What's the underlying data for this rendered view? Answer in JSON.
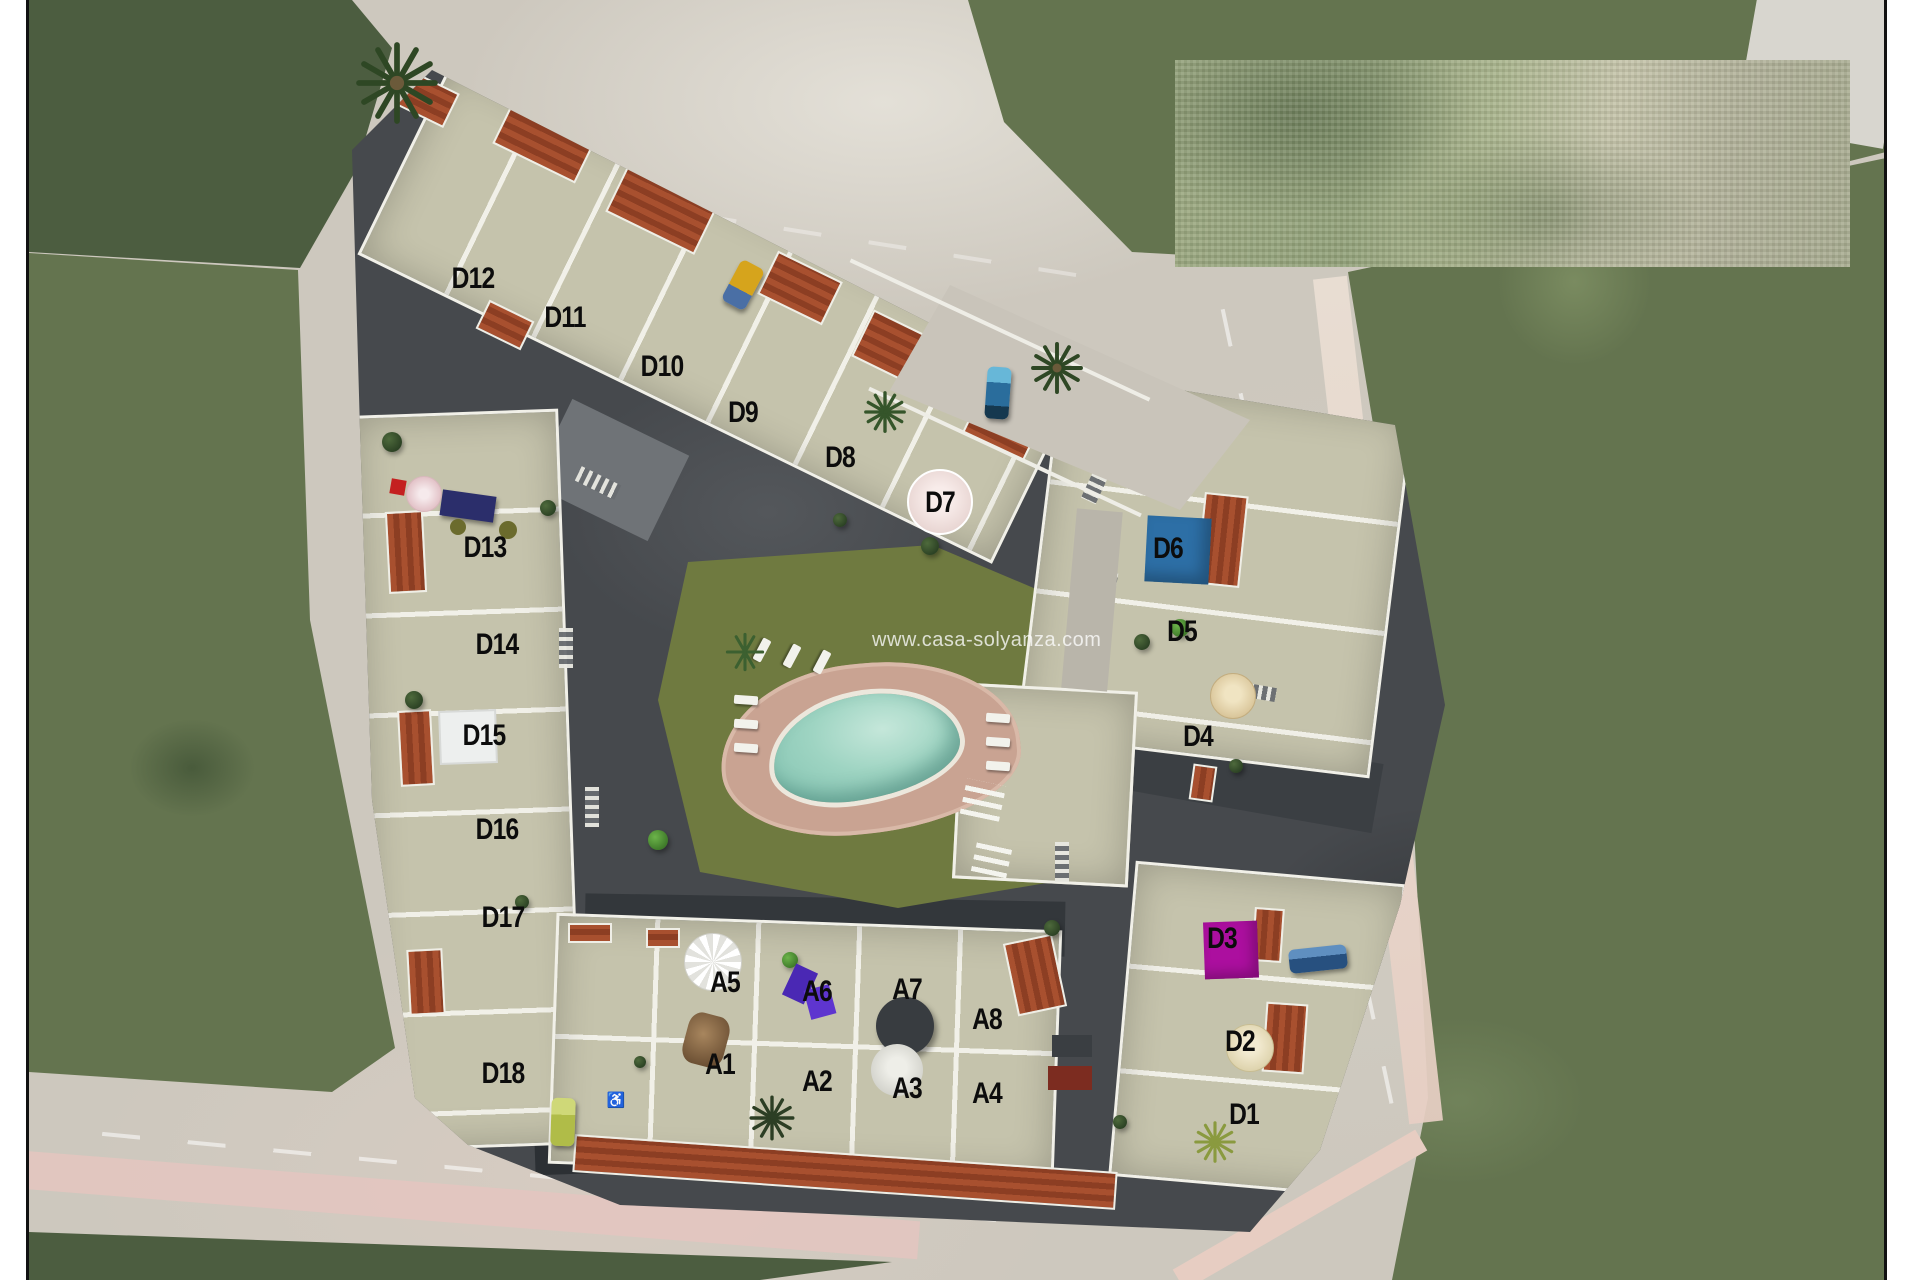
{
  "watermark": {
    "text": "www.casa-solyanza.com"
  },
  "site": {
    "unit_labels": [
      {
        "id": "D12"
      },
      {
        "id": "D11"
      },
      {
        "id": "D10"
      },
      {
        "id": "D9"
      },
      {
        "id": "D8"
      },
      {
        "id": "D7"
      },
      {
        "id": "D13"
      },
      {
        "id": "D14"
      },
      {
        "id": "D15"
      },
      {
        "id": "D16"
      },
      {
        "id": "D17"
      },
      {
        "id": "D18"
      },
      {
        "id": "D6"
      },
      {
        "id": "D5"
      },
      {
        "id": "D4"
      },
      {
        "id": "D3"
      },
      {
        "id": "D2"
      },
      {
        "id": "D1"
      },
      {
        "id": "A5"
      },
      {
        "id": "A6"
      },
      {
        "id": "A7"
      },
      {
        "id": "A8"
      },
      {
        "id": "A1"
      },
      {
        "id": "A2"
      },
      {
        "id": "A3"
      },
      {
        "id": "A4"
      }
    ],
    "highlights": {
      "d6_panel_color": "#2d6fa6",
      "d3_panel_color": "#ac0f9f"
    }
  }
}
